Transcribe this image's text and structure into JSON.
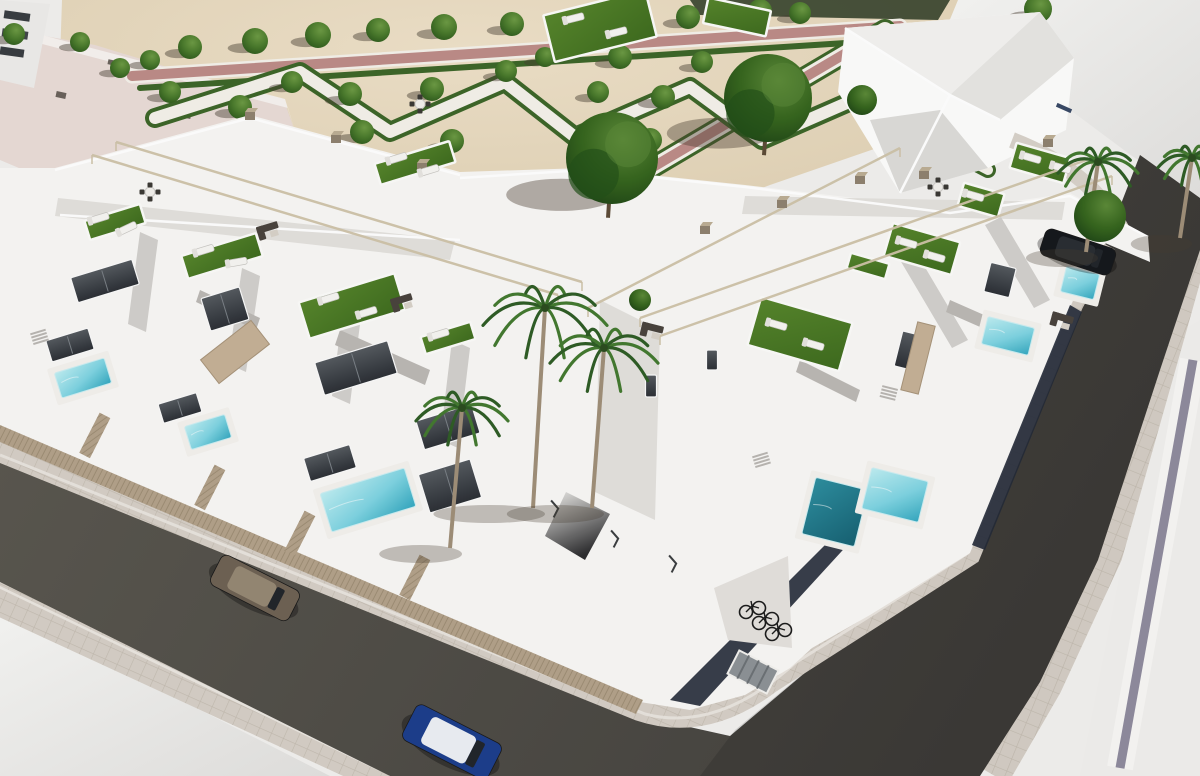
{
  "meta": {
    "title": "Aerial 3D architectural render of a white residential corner complex with pools, roof terraces and a landscaped park",
    "image_type": "architectural-render",
    "visible_text": "none"
  },
  "colors": {
    "sand": "#e7d9bc",
    "sand_light": "#eee1c8",
    "path_pink": "#bd8c88",
    "path_white": "#f4f1ea",
    "hedge_green": "#3e6629",
    "tree_green_light": "#5c8a39",
    "tree_green": "#38671f",
    "tree_green_dark": "#24511a",
    "roof_pink": "#e9dcd7",
    "red_roof": "#8d4f44",
    "building_white": "#f8f7f5",
    "facet_light": "#e3e1dd",
    "facet_mid": "#d2d0cc",
    "facet_dark": "#bbb8b4",
    "glass_dark": "#2c3036",
    "glass_light": "#565b60",
    "turf_light": "#57862c",
    "turf_dark": "#3f6c1f",
    "pool_light": "#bfeef2",
    "pool_mid": "#5ec6d8",
    "pool_deep": "#176273",
    "fence_tan": "#b3a28a",
    "fence_stripe": "#9a8971",
    "road_light": "#5d5a52",
    "road_dark": "#45433f",
    "sidewalk": "#d6cfc6",
    "sidewalk_line": "#c2bab0",
    "curb": "#eae6e0",
    "lot_white": "#f5f5f3",
    "purple_stripe": "#8f8b9e",
    "pergola": "#cfc3a9",
    "chimney": "#8f8270",
    "chimney_top": "#bcae94",
    "sofa_dark": "#4a443e",
    "lounger_white": "#f6f5f2",
    "panel_beige": "#c5b196",
    "plinth_navy": "#242a38",
    "shadow": "#4a3f33",
    "car_bronze_body": "#6f6254",
    "car_bronze_roof": "#958874",
    "car_blue_body": "#1d3f8c",
    "car_blue_roof": "#eceff4",
    "car_dark_body": "#16191d",
    "car_dark_roof": "#2a2e33",
    "bike_frame": "#1c1c1c",
    "door_gray": "#8d9296",
    "ramp_dark": "#2e2e30"
  },
  "scene": {
    "park": {
      "trees": [
        [
          14,
          34,
          11
        ],
        [
          80,
          42,
          10
        ],
        [
          150,
          60,
          10
        ],
        [
          190,
          47,
          12
        ],
        [
          255,
          41,
          13
        ],
        [
          318,
          35,
          13
        ],
        [
          378,
          30,
          12
        ],
        [
          444,
          27,
          13
        ],
        [
          512,
          24,
          12
        ],
        [
          570,
          22,
          11
        ],
        [
          688,
          17,
          12
        ],
        [
          760,
          11,
          12
        ],
        [
          800,
          13,
          11
        ],
        [
          1038,
          9,
          14
        ],
        [
          120,
          68,
          10
        ],
        [
          170,
          92,
          11
        ],
        [
          240,
          107,
          12
        ],
        [
          292,
          82,
          11
        ],
        [
          350,
          94,
          12
        ],
        [
          432,
          89,
          12
        ],
        [
          362,
          132,
          12
        ],
        [
          452,
          141,
          12
        ],
        [
          506,
          71,
          11
        ],
        [
          545,
          57,
          10
        ],
        [
          598,
          92,
          11
        ],
        [
          620,
          57,
          12
        ],
        [
          650,
          140,
          12
        ],
        [
          663,
          97,
          12
        ],
        [
          702,
          62,
          11
        ]
      ],
      "big_trees": [
        [
          612,
          158,
          46
        ],
        [
          768,
          98,
          44
        ]
      ]
    },
    "complex": {
      "turf_patches": [
        [
          115,
          222,
          58,
          20,
          -17
        ],
        [
          222,
          256,
          78,
          24,
          -17
        ],
        [
          352,
          306,
          100,
          38,
          -17
        ],
        [
          415,
          163,
          78,
          22,
          -17
        ],
        [
          600,
          26,
          105,
          48,
          -14
        ],
        [
          737,
          17,
          64,
          26,
          12
        ],
        [
          800,
          334,
          95,
          50,
          16
        ],
        [
          922,
          249,
          70,
          34,
          16
        ],
        [
          981,
          200,
          42,
          24,
          16
        ],
        [
          1040,
          163,
          56,
          26,
          16
        ],
        [
          448,
          338,
          52,
          18,
          -17
        ],
        [
          868,
          266,
          40,
          16,
          16
        ]
      ],
      "pools": [
        [
          83,
          378,
          52,
          26,
          -17,
          0
        ],
        [
          208,
          432,
          42,
          24,
          -17,
          0
        ],
        [
          368,
          500,
          88,
          40,
          -17,
          0
        ],
        [
          835,
          512,
          54,
          58,
          14,
          1
        ],
        [
          895,
          495,
          58,
          42,
          14,
          0
        ],
        [
          1008,
          336,
          48,
          28,
          14,
          0
        ],
        [
          1080,
          283,
          34,
          26,
          14,
          0
        ]
      ],
      "loungers": [
        [
          100,
          218,
          -17
        ],
        [
          128,
          228,
          -25
        ],
        [
          205,
          250,
          -17
        ],
        [
          238,
          262,
          -10
        ],
        [
          330,
          298,
          -17
        ],
        [
          368,
          312,
          -17
        ],
        [
          398,
          158,
          -17
        ],
        [
          430,
          170,
          -17
        ],
        [
          575,
          18,
          -14
        ],
        [
          618,
          32,
          -14
        ],
        [
          778,
          325,
          16
        ],
        [
          815,
          345,
          16
        ],
        [
          908,
          243,
          16
        ],
        [
          936,
          257,
          16
        ],
        [
          975,
          196,
          16
        ],
        [
          1032,
          158,
          16
        ],
        [
          1062,
          168,
          16
        ],
        [
          440,
          334,
          -17
        ]
      ],
      "sofas": [
        [
          268,
          230,
          -17
        ],
        [
          402,
          302,
          -17
        ],
        [
          652,
          330,
          14
        ],
        [
          1062,
          320,
          16
        ]
      ],
      "tables": [
        [
          150,
          192
        ],
        [
          420,
          104
        ],
        [
          938,
          187
        ]
      ],
      "pergolas": [
        [
          92,
          155,
          558,
          295
        ],
        [
          116,
          142,
          582,
          282
        ],
        [
          640,
          318,
          1092,
          158
        ],
        [
          660,
          336,
          1112,
          176
        ],
        [
          588,
          308,
          900,
          148
        ]
      ],
      "chimneys": [
        [
          250,
          116
        ],
        [
          336,
          139
        ],
        [
          422,
          167
        ],
        [
          705,
          230
        ],
        [
          782,
          204
        ],
        [
          860,
          180
        ],
        [
          924,
          175
        ],
        [
          1048,
          143
        ]
      ],
      "windows": [
        [
          105,
          281,
          64,
          26,
          -17
        ],
        [
          225,
          309,
          40,
          34,
          -17
        ],
        [
          356,
          368,
          76,
          34,
          -17
        ],
        [
          448,
          427,
          58,
          30,
          -17
        ],
        [
          450,
          486,
          54,
          40,
          -17
        ],
        [
          70,
          345,
          44,
          22,
          -17
        ],
        [
          180,
          408,
          40,
          20,
          -17
        ],
        [
          330,
          463,
          48,
          24,
          -17
        ],
        [
          651,
          386,
          11,
          22,
          0
        ],
        [
          712,
          360,
          11,
          20,
          0
        ],
        [
          913,
          352,
          30,
          36,
          14
        ],
        [
          1000,
          280,
          26,
          30,
          14
        ]
      ],
      "panels": [
        [
          235,
          352,
          64,
          30,
          -38
        ],
        [
          918,
          358,
          18,
          70,
          14
        ]
      ],
      "stairs": [
        [
          38,
          332,
          -17
        ],
        [
          890,
          388,
          14
        ],
        [
          760,
          455,
          -17
        ]
      ],
      "parking_marks": [
        [
          560,
          505,
          27
        ],
        [
          620,
          535,
          27
        ],
        [
          678,
          560,
          27
        ]
      ],
      "palms": [
        [
          545,
          308,
          62,
          200
        ],
        [
          604,
          348,
          54,
          160
        ],
        [
          462,
          408,
          46,
          140
        ],
        [
          1098,
          162,
          40,
          90
        ],
        [
          1192,
          158,
          34,
          80
        ]
      ],
      "bushes": [
        [
          1100,
          216,
          26
        ],
        [
          862,
          100,
          15
        ],
        [
          640,
          300,
          11
        ]
      ],
      "cars": [
        {
          "name": "bronze-car",
          "x": 255,
          "y": 588,
          "rot": 27,
          "len": 88,
          "wid": 34,
          "body": "car_bronze_body",
          "roof": "car_bronze_roof"
        },
        {
          "name": "blue-car",
          "x": 452,
          "y": 742,
          "rot": 27,
          "len": 96,
          "wid": 40,
          "body": "car_blue_body",
          "roof": "car_blue_roof"
        },
        {
          "name": "dark-car",
          "x": 1078,
          "y": 252,
          "rot": 18,
          "len": 74,
          "wid": 28,
          "body": "car_dark_body",
          "roof": "car_dark_roof"
        }
      ],
      "bikes": {
        "x": 746,
        "y": 612,
        "count": 3,
        "dx": 13,
        "dy": 11
      }
    }
  }
}
